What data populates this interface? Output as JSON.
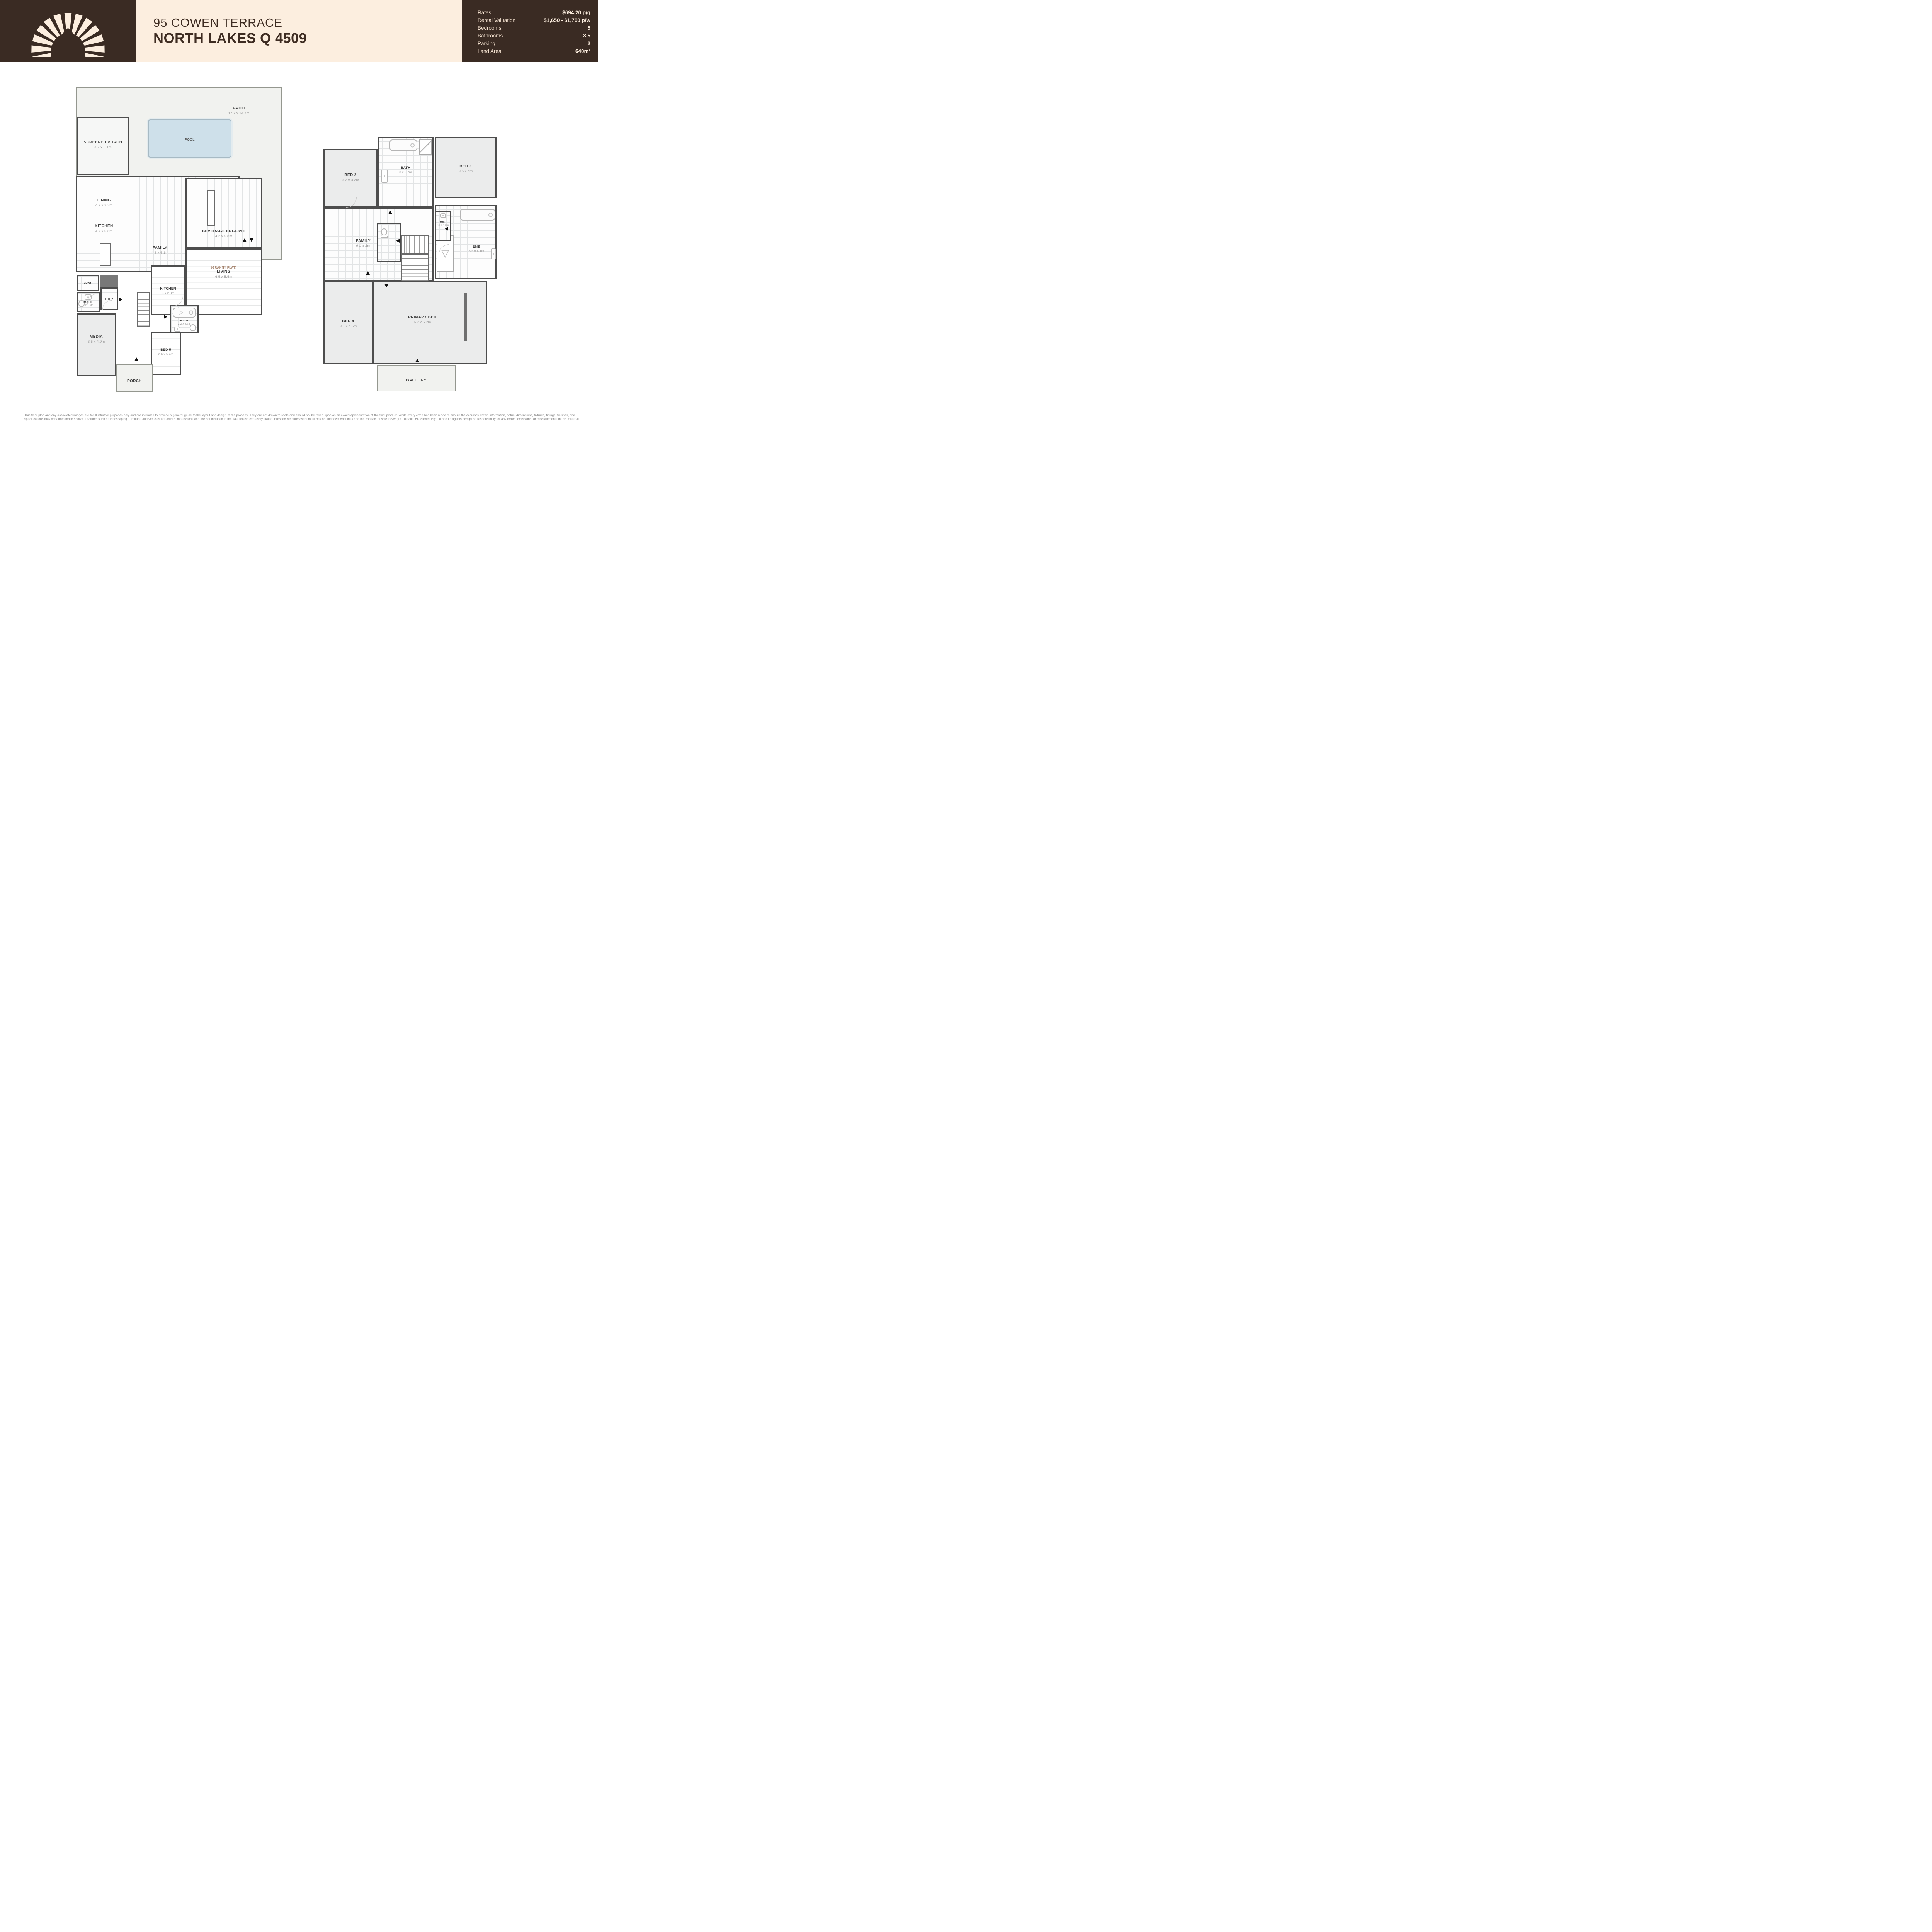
{
  "header": {
    "title_line1": "95 COWEN TERRACE",
    "title_line2": "NORTH LAKES Q 4509",
    "compass_letter": "N",
    "details": {
      "rates_label": "Rates",
      "rates_value": "$694.20 p/q",
      "rental_label": "Rental Valuation",
      "rental_value": "$1,650 - $1,700 p/w",
      "bedrooms_label": "Bedrooms",
      "bedrooms_value": "5",
      "bathrooms_label": "Bathrooms",
      "bathrooms_value": "3.5",
      "parking_label": "Parking",
      "parking_value": "2",
      "land_label": "Land Area",
      "land_value": "640m²"
    }
  },
  "colors": {
    "brand_brown": "#3A2B23",
    "brand_cream": "#FCEEDF",
    "wall_gray": "#4D4D4D",
    "pool_blue": "#CEE0EA"
  },
  "ground_floor": {
    "patio": {
      "name": "PATIO",
      "dims": "17.7 x 14.7m"
    },
    "pool": {
      "name": "POOL"
    },
    "screened_porch": {
      "name": "SCREENED PORCH",
      "dims": "4.7 x 5.1m"
    },
    "dining": {
      "name": "DINING",
      "dims": "4.7 x 3.3m"
    },
    "kitchen": {
      "name": "KITCHEN",
      "dims": "4.7 x 5.8m"
    },
    "family": {
      "name": "FAMILY",
      "dims": "4.8 x 5.1m"
    },
    "beverage_enclave": {
      "name": "BEVERAGE ENCLAVE",
      "dims": "4.2 x 5.8m"
    },
    "granny_living": {
      "tag": "(GRANNY FLAT)",
      "name": "LIVING",
      "dims": "6.5 x 5.5m"
    },
    "granny_kitchen": {
      "name": "KITCHEN",
      "dims": "3 x 2.3m"
    },
    "ldry": {
      "name": "LDRY"
    },
    "ptry": {
      "name": "PTRY"
    },
    "bath": {
      "name": "BATH",
      "dims": "1 x 1.5m"
    },
    "media": {
      "name": "MEDIA",
      "dims": "3.5 x 4.9m"
    },
    "granny_bath": {
      "name": "BATH",
      "dims": "2.2 x 2.2m"
    },
    "bed5": {
      "name": "BED 5",
      "dims": "2.6 x 5.4m"
    },
    "porch": {
      "name": "PORCH"
    }
  },
  "upper_floor": {
    "bed2": {
      "name": "BED 2",
      "dims": "3.2 x 3.2m"
    },
    "bath": {
      "name": "BATH",
      "dims": "3 x 2.7m"
    },
    "bed3": {
      "name": "BED 3",
      "dims": "3.5 x 4m"
    },
    "family": {
      "name": "FAMILY",
      "dims": "6.4 x 4m"
    },
    "wc": {
      "name": "WC",
      "dims": "0.9 x 1.8m"
    },
    "ens": {
      "name": "ENS",
      "dims": "3.5 x 4.1m"
    },
    "bed4": {
      "name": "BED 4",
      "dims": "3.1 x 4.6m"
    },
    "primary_bed": {
      "name": "PRIMARY BED",
      "dims": "6.2 x 5.2m"
    },
    "balcony": {
      "name": "BALCONY"
    }
  },
  "footer": {
    "disclaimer": "This floor plan and any associated images are for illustrative purposes only and are intended to provide a general guide to the layout and design of the property. They are not drawn to scale and should not be relied upon as an exact representation of the final product. While every effort has been made to ensure the accuracy of this information, actual dimensions, fixtures, fittings, finishes, and specifications may vary from those shown. Features such as landscaping, furniture, and vehicles are artist's impressions and are not included in the sale unless expressly stated. Prospective purchasers must rely on their own enquiries and the contract of sale to verify all details. BD Stories Pty Ltd and its agents accept no responsibility for any errors, omissions, or misstatements in this material. Copyright © 2024–2025 BD Stories Pty Ltd. All rights reserved. No part of this floor plan or design may be reproduced, stored, or transmitted in any form or by any means without the prior written permission of the copyright holder."
  }
}
